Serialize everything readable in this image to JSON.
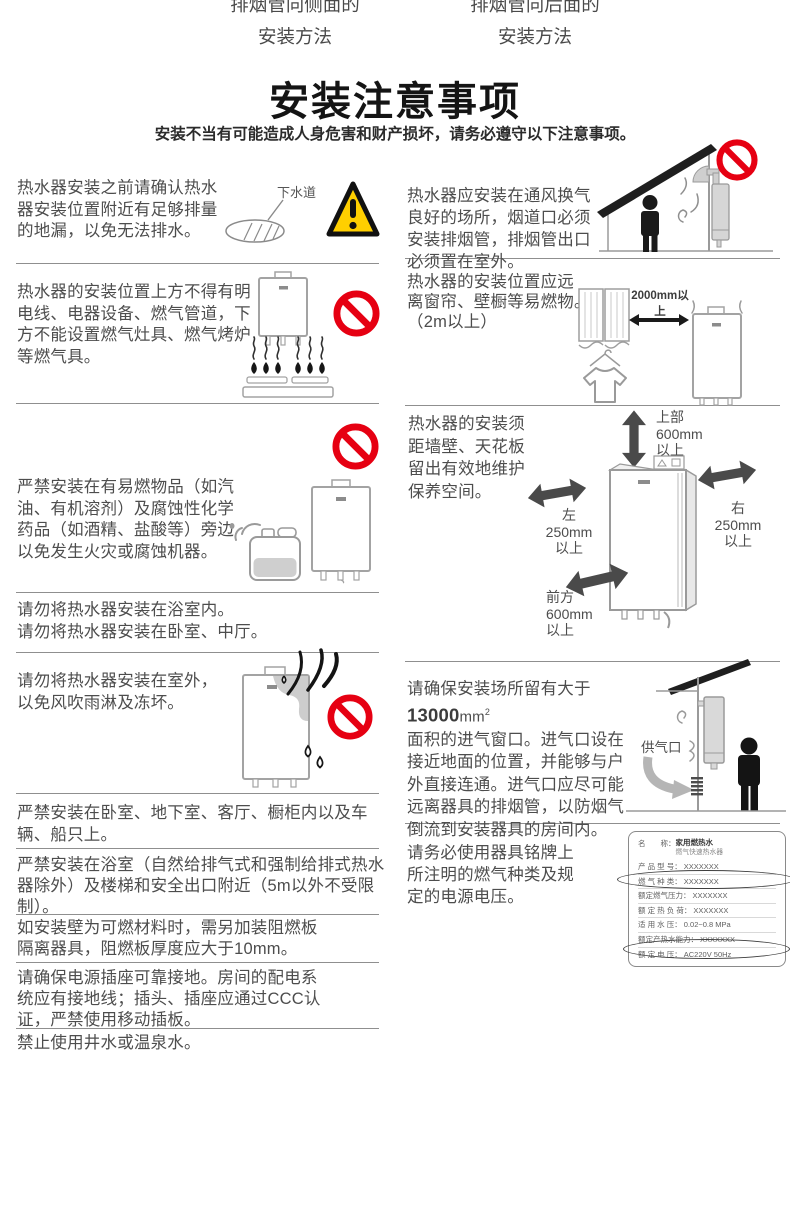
{
  "colors": {
    "prohibition_red": "#e60012",
    "warning_yellow": "#ffcf00"
  },
  "header": {
    "method_left_line1": "排烟管向侧面的",
    "method_left_line2": "安装方法",
    "method_right_line1": "排烟管向后面的",
    "method_right_line2": "安装方法",
    "title": "安装注意事项",
    "subtitle": "安装不当有可能造成人身危害和财产损坏，请务必遵守以下注意事项。"
  },
  "left": {
    "s1": {
      "text": "热水器安装之前请确认热水\n器安装位置附近有足够排量\n的地漏，以免无法排水。",
      "drain_label": "下水道"
    },
    "s2": {
      "text": "热水器的安装位置上方不得有明\n电线、电器设备、燃气管道，下\n方不能设置燃气灶具、燃气烤炉\n等燃气具。"
    },
    "s3": {
      "text": "严禁安装在有易燃物品（如汽\n油、有机溶剂）及腐蚀性化学\n药品（如酒精、盐酸等）旁边\n以免发生火灾或腐蚀机器。"
    },
    "s4": {
      "text": "请勿将热水器安装在浴室内。\n请勿将热水器安装在卧室、中厅。"
    },
    "s5": {
      "text": "请勿将热水器安装在室外，\n以免风吹雨淋及冻坏。"
    },
    "s6": {
      "text": "严禁安装在卧室、地下室、客厅、橱柜内以及车\n辆、船只上。"
    },
    "s7": {
      "text": "严禁安装在浴室（自然给排气式和强制给排式热水\n器除外）及楼梯和安全出口附近（5m以外不受限\n制）。"
    },
    "s8": {
      "text": "如安装壁为可燃材料时，需另加装阻燃板\n隔离器具，阻燃板厚度应大于10mm。"
    },
    "s9": {
      "text": "请确保电源插座可靠接地。房间的配电系\n统应有接地线；插头、插座应通过CCC认\n证，严禁使用移动插板。"
    },
    "s10": {
      "text": "禁止使用井水或温泉水。"
    }
  },
  "right": {
    "r1": {
      "text": "热水器应安装在通风换气\n良好的场所，烟道口必须\n安装排烟管，排烟管出口\n必须置在室外。"
    },
    "r2": {
      "text": "热水器的安装位置应远\n离窗帘、壁橱等易燃物。\n（2m以上）",
      "arrow_label": "2000mm以上"
    },
    "r3": {
      "text": "热水器的安装须\n距墙壁、天花板\n留出有效地维护\n保养空间。",
      "top_label": "上部\n600mm\n以上",
      "left_label": "左\n250mm\n以上",
      "right_label": "右\n250mm\n以上",
      "front_label": "前方\n600mm\n以上"
    },
    "r4": {
      "pre": "请确保安装场所留有大于",
      "big": "13000",
      "unit": "mm",
      "sup": "2",
      "rest": "\n面积的进气窗口。进气口设在\n接近地面的位置，并能够与户\n外直接连通。进气口应尽可能\n远离器具的排烟管，以防烟气\n倒流到安装器具的房间内。",
      "vent_label": "供气口"
    },
    "r5": {
      "text": "请务必使用器具铭牌上\n所注明的燃气种类及规\n定的电源电压。",
      "nameplate": {
        "rows": [
          {
            "label": "名　　称：",
            "value": "家用燃热水",
            "value2": "燃气快速热水器"
          },
          {
            "label": "产 品 型 号：",
            "value": "XXXXXXX"
          },
          {
            "label": "燃 气 种 类：",
            "value": "XXXXXXX"
          },
          {
            "label": "额定燃气压力：",
            "value": "XXXXXXX"
          },
          {
            "label": "额 定 热 负 荷：",
            "value": "XXXXXXX"
          },
          {
            "label": "适 用 水 压：",
            "value": "0.02~0.8 MPa"
          },
          {
            "label": "额定产热水能力：",
            "value": "XXXXXXX"
          },
          {
            "label": "额 定 电 压：",
            "value": "AC220V 50Hz"
          }
        ]
      }
    }
  }
}
